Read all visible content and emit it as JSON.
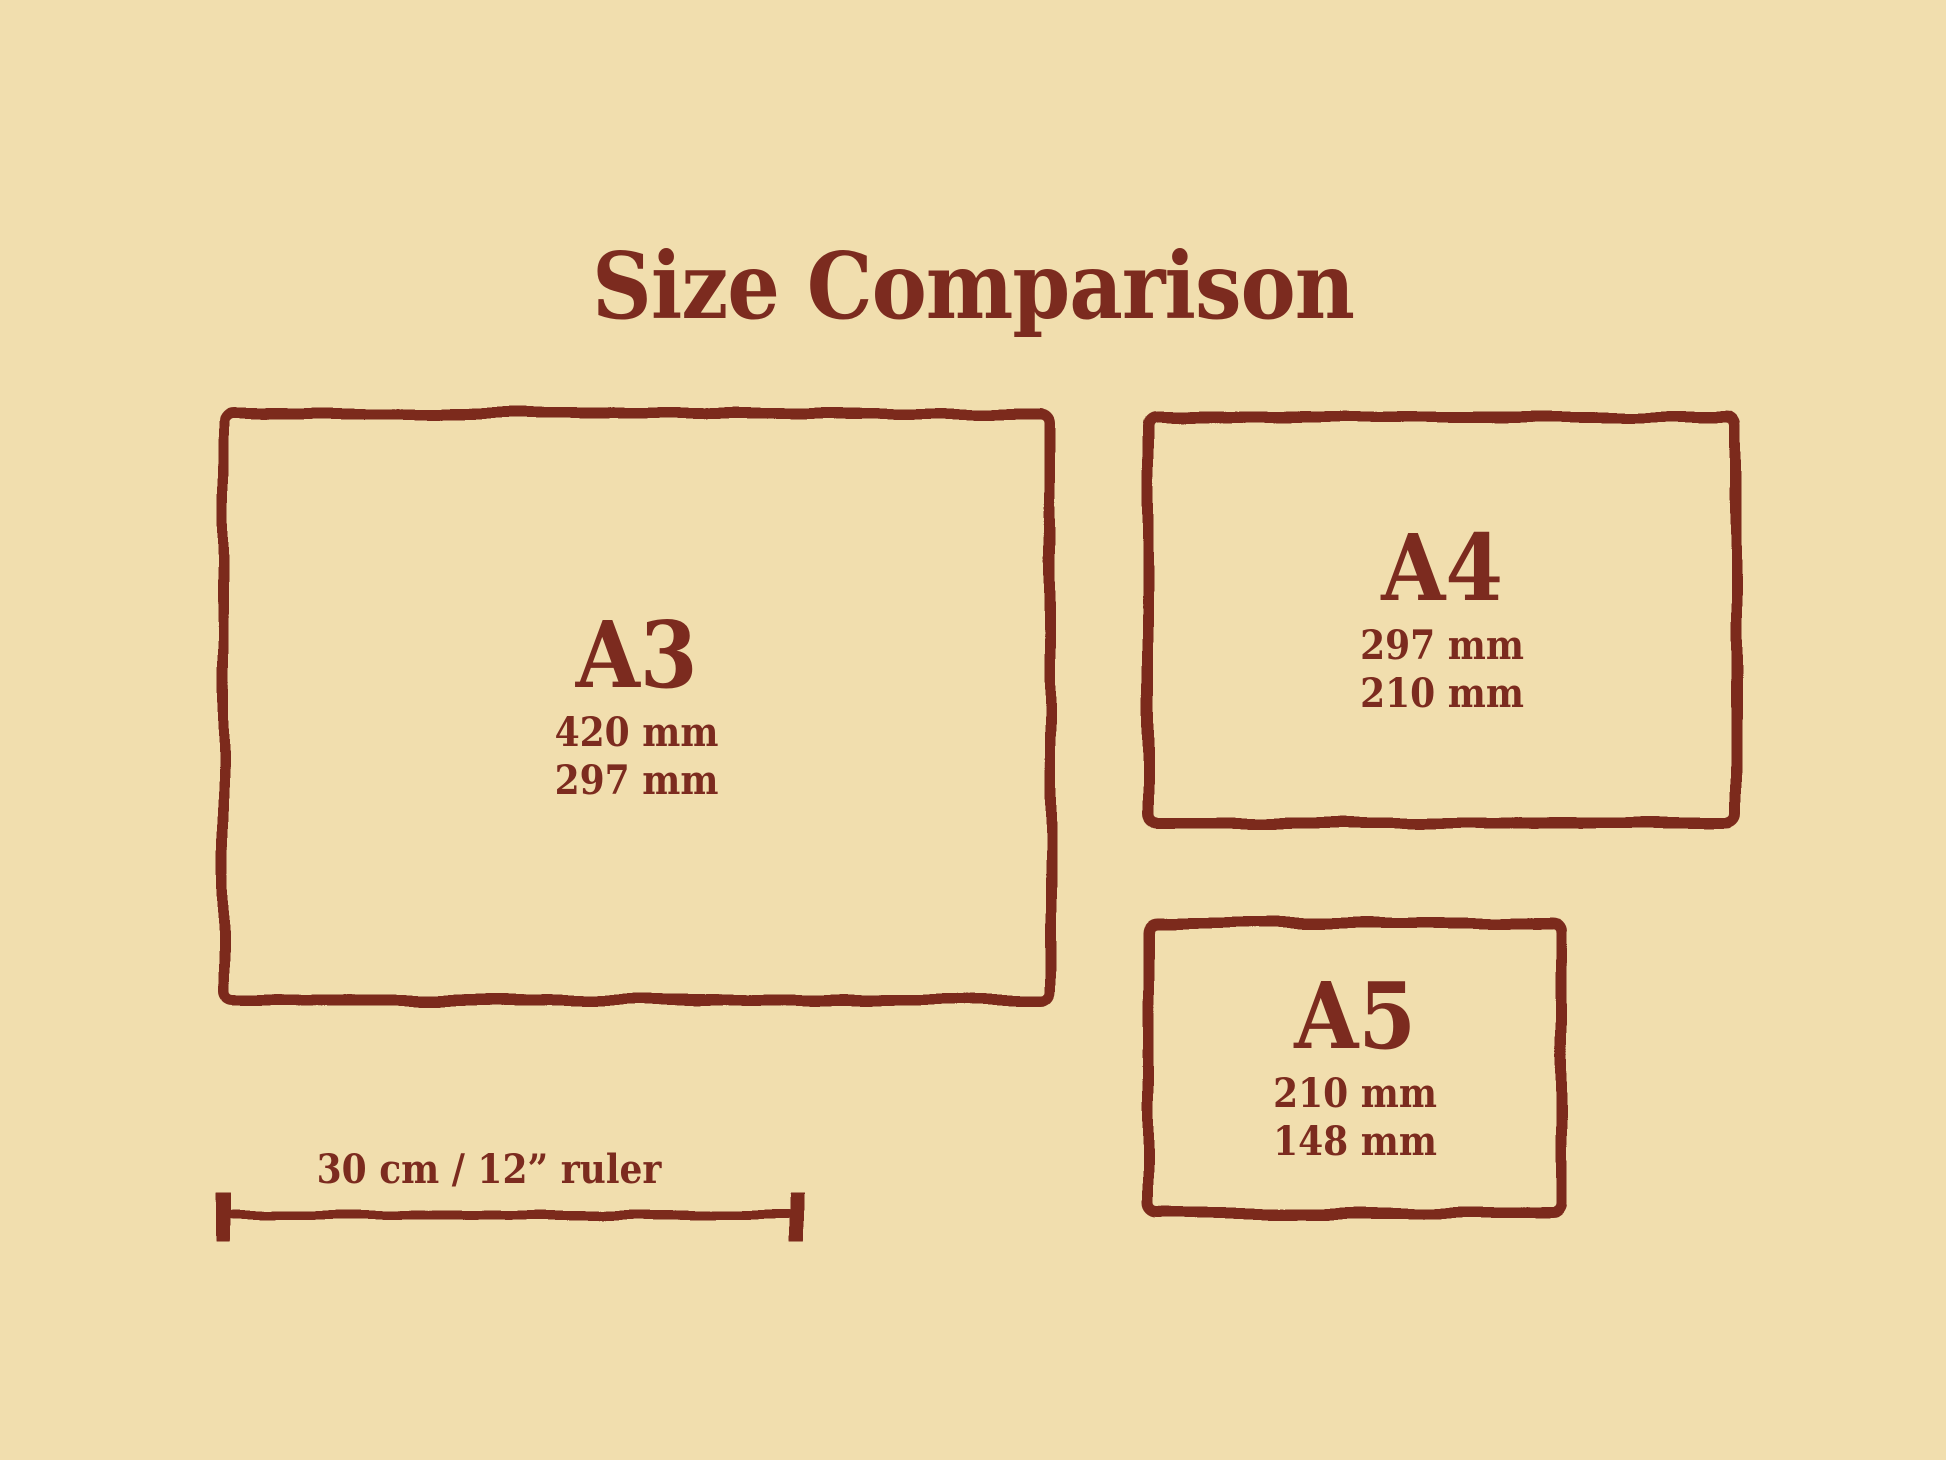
{
  "title": "Size Comparison",
  "colors": {
    "background": "#f1deae",
    "ink": "#7c2b1f"
  },
  "papers": [
    {
      "id": "a3",
      "label": "A3",
      "dim1": "420 mm",
      "dim2": "297 mm"
    },
    {
      "id": "a4",
      "label": "A4",
      "dim1": "297 mm",
      "dim2": "210 mm"
    },
    {
      "id": "a5",
      "label": "A5",
      "dim1": "210 mm",
      "dim2": "148 mm"
    }
  ],
  "ruler": {
    "label": "30 cm / 12” ruler"
  }
}
